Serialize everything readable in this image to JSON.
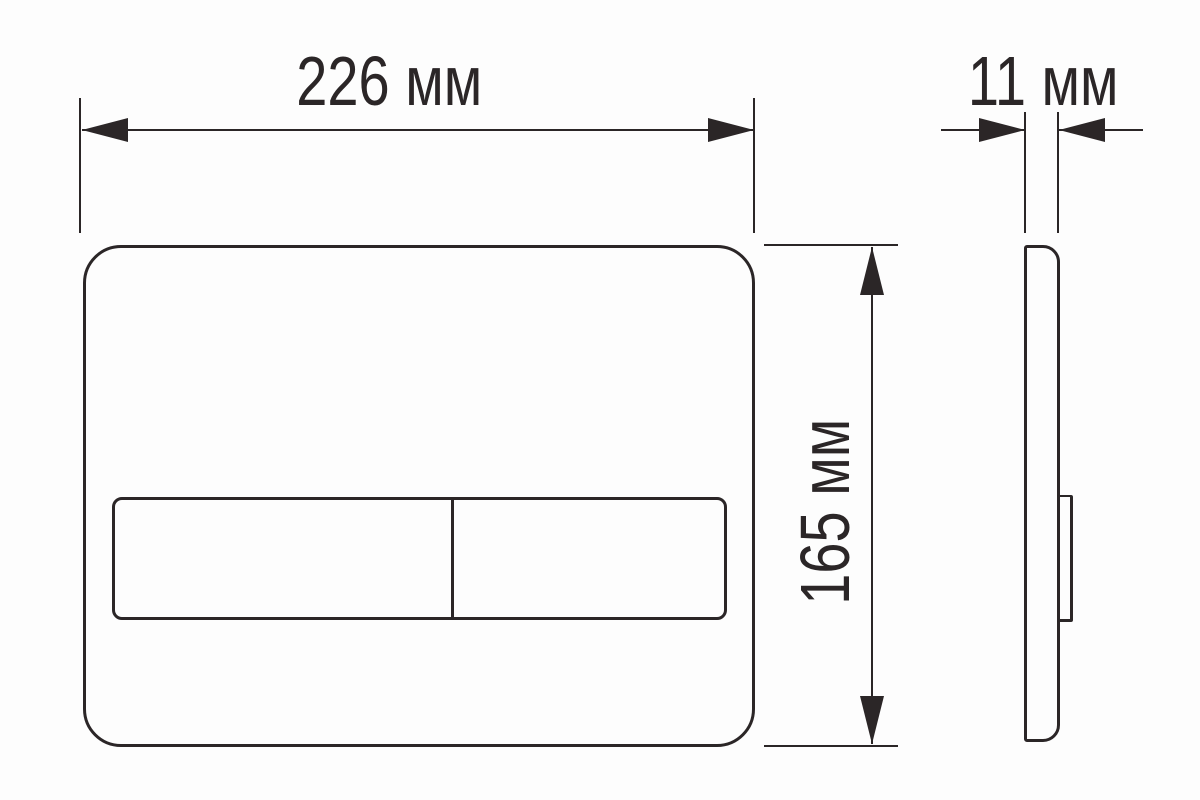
{
  "dimensions": {
    "width": {
      "label": "226 мм",
      "value": 226,
      "unit": "мм"
    },
    "height": {
      "label": "165 мм",
      "value": 165,
      "unit": "мм"
    },
    "depth": {
      "label": "11 мм",
      "value": 11,
      "unit": "мм"
    }
  },
  "colors": {
    "line": "#2b2627",
    "background": "#fdfdfd"
  }
}
